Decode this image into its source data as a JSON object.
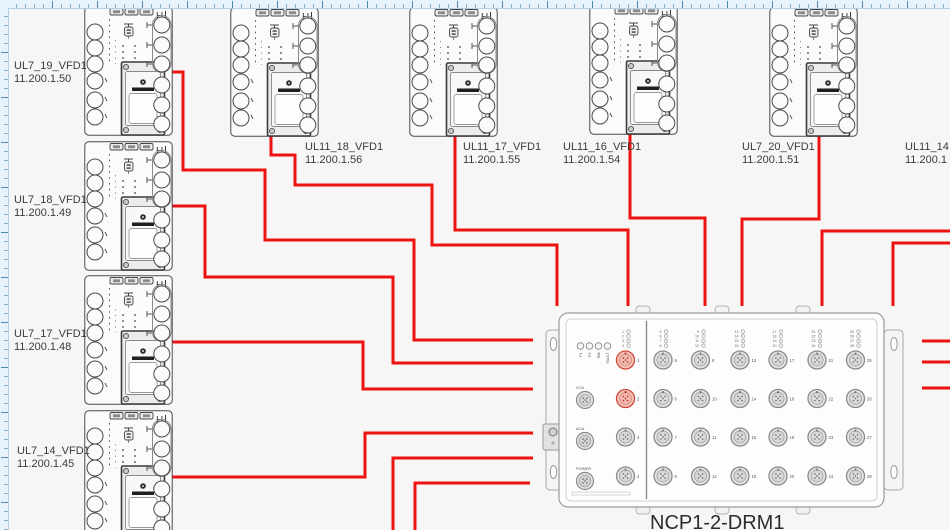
{
  "canvas": {
    "background": "#f6f6f6",
    "ruler_background": "#e7f3fa"
  },
  "colors": {
    "cable": "#ee1211",
    "device_outline": "#4a4a4a",
    "label_text": "#3b3b3b",
    "port_red_fill": "#f6c5bc",
    "port_red_stroke": "#cf4a3a"
  },
  "vfd_symbol": {
    "corner_label": "H"
  },
  "devices": [
    {
      "name": "UL7_19_VFD1",
      "ip": "11.200.1.50"
    },
    {
      "name": "UL7_18_VFD1",
      "ip": "11.200.1.49"
    },
    {
      "name": "UL7_17_VFD1",
      "ip": "11.200.1.48"
    },
    {
      "name": "UL7_14_VFD1",
      "ip": "11.200.1.45"
    },
    {
      "name": "UL11_18_VFD1",
      "ip": "11.200.1.56"
    },
    {
      "name": "UL11_17_VFD1",
      "ip": "11.200.1.55"
    },
    {
      "name": "UL11_16_VFD1",
      "ip": "11.200.1.54"
    },
    {
      "name": "UL7_20_VFD1",
      "ip": "11.200.1.51"
    },
    {
      "name": "UL11_14",
      "ip": "11.200.1"
    }
  ],
  "drm": {
    "title": "NCP1-2-DRM1",
    "status_leds": [
      "P1",
      "P2",
      "RM",
      "FAULT"
    ],
    "connectors": [
      "V.24",
      "ACA",
      "POWER"
    ],
    "led_groups": [
      [
        1,
        4
      ],
      [
        5,
        8
      ],
      [
        9,
        12
      ],
      [
        13,
        16
      ],
      [
        17,
        20
      ],
      [
        21,
        24
      ],
      [
        25,
        28
      ]
    ],
    "ports": [
      1,
      2,
      3,
      4,
      5,
      6,
      7,
      8,
      9,
      10,
      11,
      12,
      13,
      14,
      15,
      16,
      17,
      18,
      19,
      20,
      21,
      22,
      23,
      24,
      25,
      26,
      27,
      28
    ],
    "highlighted_ports": [
      1,
      2
    ]
  }
}
